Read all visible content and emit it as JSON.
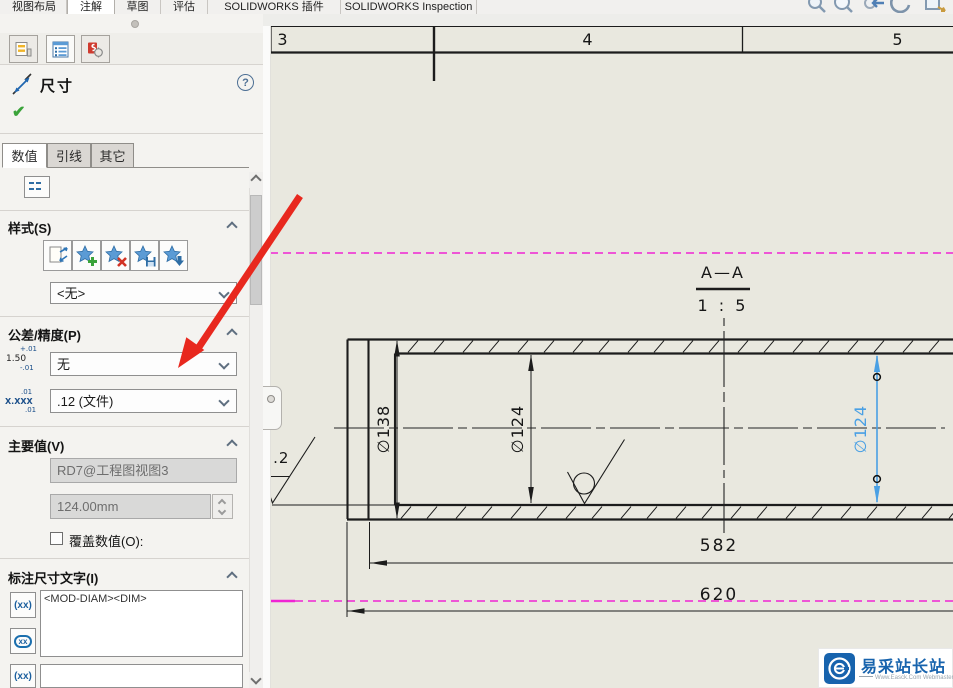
{
  "menu": {
    "tabs": [
      "视图布局",
      "注解",
      "草图",
      "评估",
      "SOLIDWORKS 插件",
      "SOLIDWORKS Inspection"
    ],
    "active_tab": "注解"
  },
  "toolbar_icons": [
    "zoom-to-fit",
    "zoom-to-area",
    "previous-view",
    "rotate-view",
    "pan"
  ],
  "panel": {
    "title": "尺寸",
    "help_glyph": "?",
    "ok_glyph": "✔",
    "icon_tabs": [
      "feature-manager",
      "property-manager",
      "configuration-manager"
    ],
    "value_tabs": [
      "数值",
      "引线",
      "其它"
    ],
    "active_value_tab": "数值",
    "style": {
      "label": "样式(S)",
      "value": "<无>",
      "buttons": [
        "apply-default-attributes",
        "add-or-update-style",
        "delete-style",
        "save-style",
        "load-style"
      ]
    },
    "tolerance": {
      "label": "公差/精度(P)",
      "type_value": "无",
      "precision_value": ".12 (文件)",
      "tol_icon": {
        "plus": "+.01",
        "value": "1.50",
        "minus": "-.01"
      },
      "prec_icon": {
        "top": ".01",
        "value": "X.XXX",
        "bottom": ".01"
      }
    },
    "primary": {
      "label": "主要值(V)",
      "name": "RD7@工程图视图3",
      "value": "124.00mm",
      "override_label": "覆盖数值(O):"
    },
    "dim_text": {
      "label": "标注尺寸文字(I)",
      "value": "<MOD-DIAM><DIM>",
      "icon1": "(xx)",
      "icon2": "xx",
      "icon3": "(xx)"
    }
  },
  "drawing": {
    "zones": [
      "3",
      "4",
      "5"
    ],
    "section_label": "A—A",
    "section_scale": "1 : 5",
    "dim_diameter_outer": "∅138",
    "dim_diameter_inner": "∅124",
    "dim_diameter_selected": "∅124",
    "dim_length_inner": "582",
    "dim_length_overall": "620",
    "surface_roughness": "3.2"
  },
  "watermark": {
    "name": "易采站长站",
    "subtitle": "Www.Easck.Com Webmaster"
  },
  "colors": {
    "selection_blue": "#4aa0e4",
    "sheet": "#e9e8df",
    "magenta_guide": "#f024d4",
    "tutorial_arrow_red": "#e8281e",
    "watermark_blue": "#1763ad"
  }
}
